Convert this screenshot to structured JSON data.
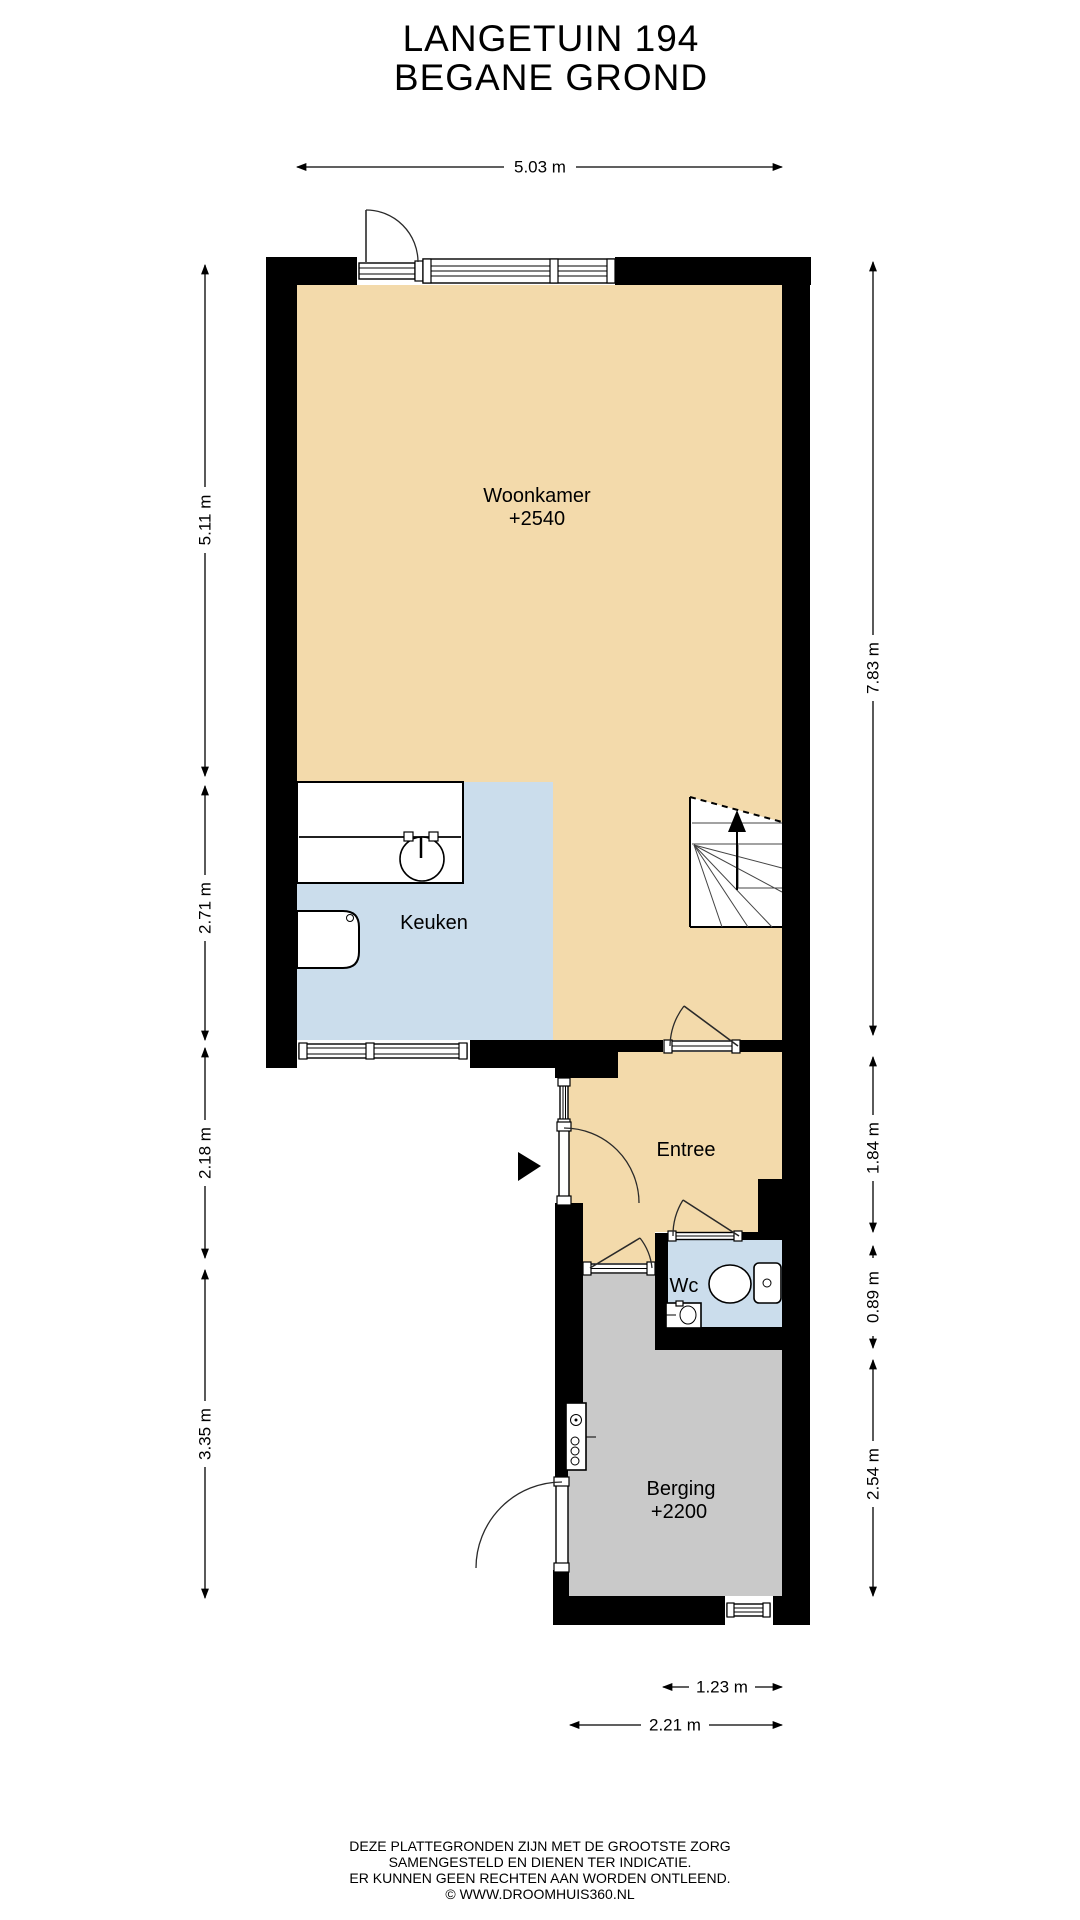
{
  "title": {
    "line1": "LANGETUIN 194",
    "line2": "BEGANE GROND"
  },
  "rooms": {
    "woonkamer": {
      "name": "Woonkamer",
      "ceiling": "+2540"
    },
    "keuken": {
      "name": "Keuken"
    },
    "entree": {
      "name": "Entree"
    },
    "wc": {
      "name": "Wc"
    },
    "berging": {
      "name": "Berging",
      "ceiling": "+2200"
    }
  },
  "dimensions": {
    "top_width": "5.03 m",
    "left_living": "5.11 m",
    "left_kitchen": "2.71 m",
    "left_entree": "2.18 m",
    "left_storage": "3.35 m",
    "right_main": "7.83 m",
    "right_entree": "1.84 m",
    "right_wc": "0.89 m",
    "right_storage": "2.54 m",
    "bottom_inner": "1.23 m",
    "bottom_outer": "2.21 m"
  },
  "footer": {
    "line1": "DEZE PLATTEGRONDEN ZIJN MET DE GROOTSTE ZORG",
    "line2": "SAMENGESTELD EN DIENEN TER INDICATIE.",
    "line3": "ER KUNNEN GEEN RECHTEN AAN WORDEN ONTLEEND.",
    "line4": "© WWW.DROOMHUIS360.NL"
  },
  "colors": {
    "floor_living": "#F3DAAB",
    "floor_kitchen": "#CBDDEC",
    "floor_storage": "#C9C9C9",
    "wall": "#000000"
  }
}
